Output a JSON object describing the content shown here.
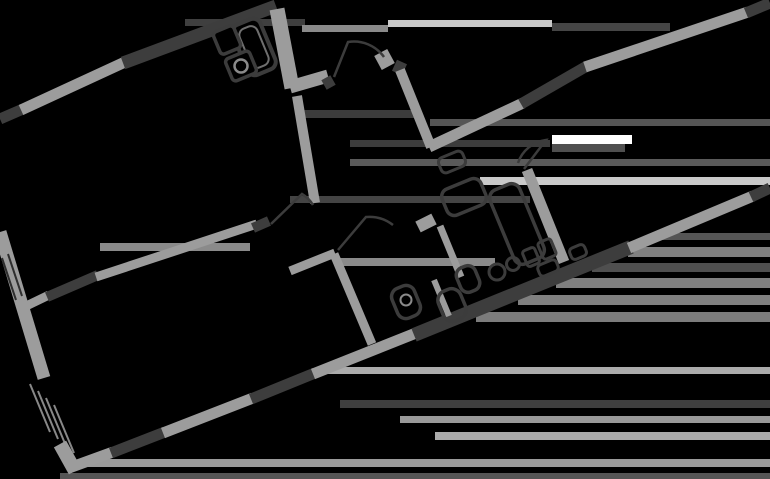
{
  "canvas": {
    "width": 770,
    "height": 479,
    "background": "#000000"
  },
  "palette": {
    "wall_light": "#9c9c9c",
    "wall_dark": "#3d3d3d",
    "outline_dark": "#3c3c3c",
    "inner_gray": "#6f6f6f",
    "knob_gray": "#8a8a8a",
    "stair_gray": "#888888",
    "wall_groove": "#2e2e2e"
  },
  "floor_plan": {
    "walls": [
      [
        0,
        119,
        23,
        109,
        11,
        "D"
      ],
      [
        21,
        110,
        125,
        62,
        11,
        "L"
      ],
      [
        123,
        63,
        276,
        6,
        13,
        "D"
      ],
      [
        277,
        9,
        292,
        88,
        15,
        "L"
      ],
      [
        290,
        87,
        328,
        76,
        13,
        "L"
      ],
      [
        324,
        85,
        333,
        80,
        11,
        "D"
      ],
      [
        297,
        96,
        315,
        203,
        10,
        "L"
      ],
      [
        378,
        63,
        391,
        56,
        16,
        "L"
      ],
      [
        397,
        73,
        402,
        62,
        11,
        "D"
      ],
      [
        400,
        70,
        431,
        147,
        10,
        "L"
      ],
      [
        429,
        147,
        523,
        103,
        11,
        "L"
      ],
      [
        521,
        104,
        587,
        66,
        11,
        "D"
      ],
      [
        585,
        67,
        748,
        12,
        11,
        "L"
      ],
      [
        746,
        13,
        770,
        3,
        11,
        "D"
      ],
      [
        527,
        170,
        564,
        262,
        11,
        "L"
      ],
      [
        20,
        309,
        49,
        295,
        9,
        "L"
      ],
      [
        47,
        297,
        98,
        275,
        10,
        "D"
      ],
      [
        96,
        277,
        257,
        224,
        9,
        "L"
      ],
      [
        253,
        228,
        269,
        221,
        10,
        "D"
      ],
      [
        290,
        271,
        335,
        253,
        9,
        "L"
      ],
      [
        334,
        254,
        372,
        344,
        9,
        "L"
      ],
      [
        0,
        232,
        44,
        378,
        13,
        "L"
      ],
      [
        60,
        444,
        75,
        471,
        14,
        "L"
      ],
      [
        69,
        468,
        113,
        452,
        11,
        "L"
      ],
      [
        111,
        453,
        165,
        432,
        11,
        "D"
      ],
      [
        163,
        433,
        253,
        398,
        11,
        "L"
      ],
      [
        251,
        399,
        315,
        373,
        11,
        "D"
      ],
      [
        313,
        374,
        416,
        333,
        11,
        "L"
      ],
      [
        414,
        335,
        631,
        247,
        14,
        "D"
      ],
      [
        629,
        248,
        753,
        196,
        11,
        "L"
      ],
      [
        751,
        197,
        770,
        188,
        11,
        "D"
      ],
      [
        418,
        227,
        434,
        219,
        12,
        "L"
      ],
      [
        440,
        226,
        461,
        277,
        7,
        "L"
      ],
      [
        434,
        280,
        449,
        316,
        6,
        "L"
      ]
    ],
    "wall_grooves": [
      [
        2,
        258,
        16,
        300
      ],
      [
        8,
        254,
        22,
        296
      ]
    ],
    "stair_lines": [
      [
        30,
        384,
        50,
        432
      ],
      [
        38,
        391,
        58,
        439
      ],
      [
        46,
        398,
        66,
        446
      ],
      [
        54,
        405,
        74,
        453
      ]
    ],
    "door_arcs": [
      {
        "name": "entrance-door-arc",
        "d": "M 334 77 L 348 42 A 37 37 0 0 1 384 57"
      },
      {
        "name": "left-room-door-arc",
        "d": "M 271 224 L 302 194 A 33 33 0 0 1 313 205"
      },
      {
        "name": "kitchen-door-arc",
        "d": "M 338 250 L 366 217 A 38 38 0 0 1 393 225"
      },
      {
        "name": "right-room-door-arc",
        "d": "M 524 169 L 546 140 A 34 34 0 0 0 518 163"
      }
    ],
    "fixture_angle": -22.5,
    "fixtures": [
      {
        "kind": "rect",
        "name": "bathtub",
        "cx": 254,
        "cy": 47,
        "w": 30,
        "h": 54,
        "rx": 8,
        "stroke": "outline_dark",
        "sw": 4,
        "fill": "#000000"
      },
      {
        "kind": "rect",
        "name": "bathtub-inner",
        "cx": 254,
        "cy": 47,
        "w": 19,
        "h": 42,
        "rx": 7,
        "stroke": "inner_gray",
        "sw": 2,
        "fill": "none"
      },
      {
        "kind": "rect",
        "name": "sink",
        "cx": 227,
        "cy": 40,
        "w": 22,
        "h": 24,
        "rx": 4,
        "stroke": "outline_dark",
        "sw": 3.5,
        "fill": "#000000"
      },
      {
        "kind": "rect",
        "name": "washing-machine",
        "cx": 241,
        "cy": 66,
        "w": 26,
        "h": 24,
        "rx": 4,
        "stroke": "outline_dark",
        "sw": 3.5,
        "fill": "#000000"
      },
      {
        "kind": "circle",
        "name": "washer-drum",
        "cx": 241,
        "cy": 66,
        "r": 6.5,
        "stroke": "knob_gray",
        "sw": 2.5,
        "fill": "none"
      },
      {
        "kind": "rect",
        "name": "entry-furniture",
        "cx": 452,
        "cy": 162,
        "w": 26,
        "h": 16,
        "rx": 5,
        "stroke": "outline_dark",
        "sw": 3,
        "fill": "none"
      },
      {
        "kind": "rect",
        "name": "furniture-outline",
        "cx": 464,
        "cy": 197,
        "w": 42,
        "h": 28,
        "rx": 8,
        "stroke": "outline_dark",
        "sw": 3.5,
        "fill": "none"
      },
      {
        "kind": "rect",
        "name": "wardrobe-outline",
        "cx": 517,
        "cy": 224,
        "w": 32,
        "h": 80,
        "rx": 9,
        "stroke": "outline_dark",
        "sw": 3.5,
        "fill": "none"
      },
      {
        "kind": "rect",
        "name": "furniture-outline",
        "cx": 548,
        "cy": 268,
        "w": 20,
        "h": 12,
        "rx": 4,
        "stroke": "outline_dark",
        "sw": 3,
        "fill": "none"
      },
      {
        "kind": "rect",
        "name": "furniture-outline",
        "cx": 578,
        "cy": 252,
        "w": 16,
        "h": 12,
        "rx": 4,
        "stroke": "outline_dark",
        "sw": 3,
        "fill": "none"
      },
      {
        "kind": "rect",
        "name": "kitchen-sink",
        "cx": 406,
        "cy": 302,
        "w": 24,
        "h": 32,
        "rx": 9,
        "stroke": "outline_dark",
        "sw": 3.5,
        "fill": "none"
      },
      {
        "kind": "circle",
        "name": "kitchen-sink-bowl",
        "cx": 406,
        "cy": 300,
        "r": 5.5,
        "stroke": "knob_gray",
        "sw": 2,
        "fill": "none"
      },
      {
        "kind": "rect",
        "name": "kitchen-appliance",
        "cx": 452,
        "cy": 305,
        "w": 24,
        "h": 32,
        "rx": 10,
        "stroke": "outline_dark",
        "sw": 3.5,
        "fill": "none"
      },
      {
        "kind": "rect",
        "name": "kitchen-appliance",
        "cx": 468,
        "cy": 279,
        "w": 20,
        "h": 26,
        "rx": 8,
        "stroke": "outline_dark",
        "sw": 3.5,
        "fill": "none"
      },
      {
        "kind": "circle",
        "name": "stove-burner",
        "cx": 497,
        "cy": 272,
        "r": 8,
        "stroke": "outline_dark",
        "sw": 3,
        "fill": "none"
      },
      {
        "kind": "circle",
        "name": "stove-burner",
        "cx": 513,
        "cy": 264,
        "r": 6.5,
        "stroke": "outline_dark",
        "sw": 3,
        "fill": "none"
      },
      {
        "kind": "rect",
        "name": "kitchen-appliance",
        "cx": 531,
        "cy": 257,
        "w": 13,
        "h": 17,
        "rx": 3,
        "stroke": "outline_dark",
        "sw": 3,
        "fill": "none"
      },
      {
        "kind": "rect",
        "name": "kitchen-appliance",
        "cx": 547,
        "cy": 249,
        "w": 14,
        "h": 18,
        "rx": 3,
        "stroke": "outline_dark",
        "sw": 3,
        "fill": "none"
      }
    ],
    "smear_bands": [
      [
        185,
        19,
        120,
        7,
        "#3f3f3f"
      ],
      [
        302,
        25,
        86,
        7,
        "#8a8a8a"
      ],
      [
        388,
        20,
        164,
        7,
        "#c9c9c9"
      ],
      [
        552,
        23,
        118,
        8,
        "#454545"
      ],
      [
        302,
        110,
        115,
        8,
        "#3c3c3c"
      ],
      [
        430,
        119,
        340,
        7,
        "#555555"
      ],
      [
        350,
        140,
        200,
        7,
        "#3c3c3c"
      ],
      [
        552,
        135,
        80,
        9,
        "#ffffff"
      ],
      [
        552,
        144,
        73,
        8,
        "#4f4f4f"
      ],
      [
        350,
        159,
        420,
        7,
        "#5a5a5a"
      ],
      [
        480,
        177,
        290,
        8,
        "#c9c9c9"
      ],
      [
        290,
        196,
        240,
        7,
        "#444444"
      ],
      [
        100,
        243,
        150,
        8,
        "#8a8a8a"
      ],
      [
        335,
        258,
        160,
        8,
        "#8a8a8a"
      ],
      [
        660,
        233,
        110,
        7,
        "#555555"
      ],
      [
        628,
        247,
        142,
        10,
        "#808080"
      ],
      [
        592,
        263,
        178,
        9,
        "#4f4f4f"
      ],
      [
        556,
        278,
        214,
        10,
        "#808080"
      ],
      [
        518,
        295,
        252,
        10,
        "#808080"
      ],
      [
        476,
        312,
        294,
        10,
        "#7c7c7c"
      ],
      [
        320,
        367,
        450,
        7,
        "#ababab"
      ],
      [
        340,
        400,
        430,
        8,
        "#3f3f3f"
      ],
      [
        400,
        416,
        370,
        7,
        "#999999"
      ],
      [
        435,
        432,
        335,
        8,
        "#ababab"
      ],
      [
        88,
        459,
        682,
        8,
        "#9a9a9a"
      ],
      [
        60,
        473,
        710,
        6,
        "#555555"
      ]
    ]
  }
}
